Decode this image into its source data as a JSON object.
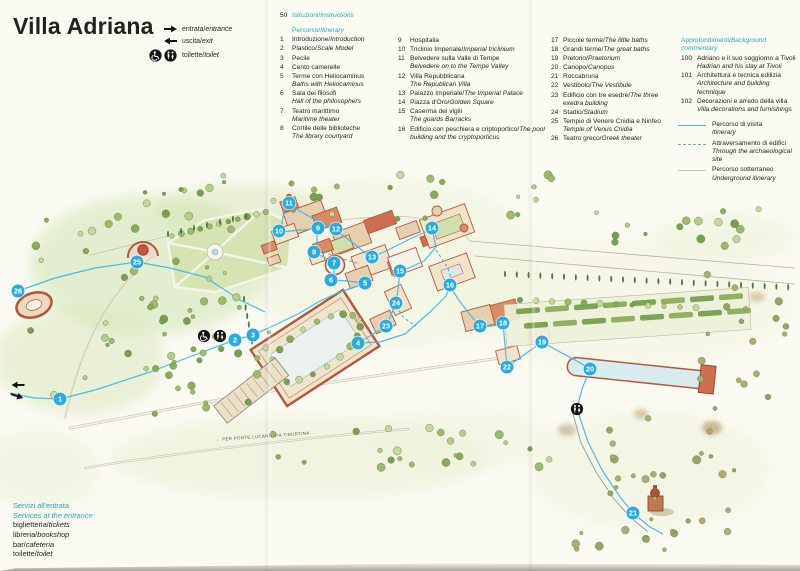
{
  "title": "Villa Adriana",
  "access_legend": {
    "items": [
      {
        "icon": "entrance-arrow",
        "it": "entrata",
        "en": "entrance"
      },
      {
        "icon": "exit-arrow",
        "it": "uscita",
        "en": "exit"
      },
      {
        "icon": "toilet-pair",
        "it": "toilette",
        "en": "toilet"
      }
    ]
  },
  "instructions": {
    "number": "50",
    "it": "Istruzioni",
    "en": "Instructions"
  },
  "itinerary": {
    "heading_it": "Percorso",
    "heading_en": "Itinerary",
    "items": [
      {
        "n": "1",
        "it": "Introduzione",
        "en": "Introduction",
        "sep": "/"
      },
      {
        "n": "2",
        "it": "Plastico",
        "en": "Scale Model",
        "sep": "/"
      },
      {
        "n": "3",
        "it": "Pecile",
        "en": "",
        "sep": ""
      },
      {
        "n": "4",
        "it": "Cento camerelle",
        "en": "",
        "sep": ""
      },
      {
        "n": "5",
        "it": "Terme con Heliocaminus",
        "en": "Baths with Heliocaminus",
        "sep": "br"
      },
      {
        "n": "6",
        "it": "Sala dei filosofi",
        "en": "Hall of the philosophers",
        "sep": "br"
      },
      {
        "n": "7",
        "it": "Teatro marittimo",
        "en": "Maritime theater",
        "sep": "br"
      },
      {
        "n": "8",
        "it": "Cortile delle biblioteche",
        "en": "The library courtyard",
        "sep": "br"
      },
      {
        "n": "9",
        "it": "Hospitalia",
        "en": "",
        "sep": ""
      },
      {
        "n": "10",
        "it": "Triclinio Imperiale",
        "en": "Imperial triclinium",
        "sep": "/"
      },
      {
        "n": "11",
        "it": "Belvedere sulla Valle di Tempe",
        "en": "Belvedere on to the Tempe Valley",
        "sep": "br"
      },
      {
        "n": "12",
        "it": "Villa Repubblicana",
        "en": "The Republican Villa",
        "sep": "br"
      },
      {
        "n": "13",
        "it": "Palazzo Imperiale",
        "en": "The Imperial Palace",
        "sep": "/"
      },
      {
        "n": "14",
        "it": "Piazza d'Oro",
        "en": "Golden Square",
        "sep": "/"
      },
      {
        "n": "15",
        "it": "Caserma dei vigili",
        "en": "The guards Barracks",
        "sep": "br"
      },
      {
        "n": "16",
        "it": "Edificio con peschiera e criptoportico",
        "en": "The pool building and the cryptoporticus",
        "sep": "/"
      },
      {
        "n": "17",
        "it": "Piccole terme",
        "en": "The little baths",
        "sep": "/"
      },
      {
        "n": "18",
        "it": "Grandi terme",
        "en": "The great baths",
        "sep": "/"
      },
      {
        "n": "19",
        "it": "Pretorio",
        "en": "Praetorium",
        "sep": "/"
      },
      {
        "n": "20",
        "it": "Canopo",
        "en": "Canopus",
        "sep": "/"
      },
      {
        "n": "21",
        "it": "Roccabruna",
        "en": "",
        "sep": ""
      },
      {
        "n": "22",
        "it": "Vestibolo",
        "en": "The Vestibule",
        "sep": "/"
      },
      {
        "n": "23",
        "it": "Edificio con tre esedre",
        "en": "The three exedra building",
        "sep": "/"
      },
      {
        "n": "24",
        "it": "Stadio",
        "en": "Stadium",
        "sep": "/"
      },
      {
        "n": "25",
        "it": "Tempio di Venere Cnidia e Ninfeo",
        "en": "Temple of Venus Cnidia",
        "sep": "br"
      },
      {
        "n": "26",
        "it": "Teatro greco",
        "en": "Greek theater",
        "sep": "/"
      }
    ]
  },
  "background": {
    "heading_it": "Approfondimenti",
    "heading_en": "Background commentary",
    "items": [
      {
        "n": "100",
        "it": "Adriano e il suo soggiorno a Tivoli",
        "en": "Hadrian and his stay at Tivoli"
      },
      {
        "n": "101",
        "it": "Architettura e tecnica edilizia",
        "en": "Architecture and building technique"
      },
      {
        "n": "102",
        "it": "Decorazioni e arredo della villa",
        "en": "Villa decorations and furnishings"
      }
    ]
  },
  "route_legend": {
    "items": [
      {
        "style": "solid",
        "it": "Percorso di visita",
        "en": "Itinerary"
      },
      {
        "style": "dashed",
        "it": "Attraversamento di edifici",
        "en": "Through the archaeological site"
      },
      {
        "style": "gray",
        "it": "Percorso sotterraneo",
        "en": "Underground itinerary"
      }
    ]
  },
  "services": {
    "heading_it": "Servizi all'entrata",
    "heading_en": "Services at the entrance",
    "items": [
      {
        "it": "biglietteria",
        "en": "tickets"
      },
      {
        "it": "libreria",
        "en": "bookshop"
      },
      {
        "it": "bar",
        "en": "cafeteria"
      },
      {
        "it": "toilette",
        "en": "toilet"
      }
    ]
  },
  "map": {
    "road_label": "← PER PONTE LUCANO VIA TIBURTINA",
    "marker_color": "#29abe2",
    "route_color": "#45b5e8",
    "markers": [
      {
        "n": "1",
        "x": 60,
        "y": 399
      },
      {
        "n": "2",
        "x": 235,
        "y": 340
      },
      {
        "n": "3",
        "x": 253,
        "y": 335
      },
      {
        "n": "4",
        "x": 358,
        "y": 343
      },
      {
        "n": "5",
        "x": 365,
        "y": 283
      },
      {
        "n": "6",
        "x": 331,
        "y": 280
      },
      {
        "n": "7",
        "x": 334,
        "y": 263
      },
      {
        "n": "8",
        "x": 314,
        "y": 252
      },
      {
        "n": "9",
        "x": 318,
        "y": 228
      },
      {
        "n": "10",
        "x": 279,
        "y": 231
      },
      {
        "n": "11",
        "x": 289,
        "y": 203
      },
      {
        "n": "12",
        "x": 336,
        "y": 229
      },
      {
        "n": "13",
        "x": 372,
        "y": 257
      },
      {
        "n": "14",
        "x": 432,
        "y": 228
      },
      {
        "n": "15",
        "x": 400,
        "y": 271
      },
      {
        "n": "16",
        "x": 450,
        "y": 285
      },
      {
        "n": "17",
        "x": 480,
        "y": 326
      },
      {
        "n": "18",
        "x": 503,
        "y": 323
      },
      {
        "n": "19",
        "x": 542,
        "y": 342
      },
      {
        "n": "20",
        "x": 590,
        "y": 369
      },
      {
        "n": "21",
        "x": 633,
        "y": 513
      },
      {
        "n": "22",
        "x": 507,
        "y": 367
      },
      {
        "n": "23",
        "x": 386,
        "y": 326
      },
      {
        "n": "24",
        "x": 396,
        "y": 303
      },
      {
        "n": "25",
        "x": 137,
        "y": 262
      },
      {
        "n": "26",
        "x": 18,
        "y": 291
      }
    ]
  }
}
